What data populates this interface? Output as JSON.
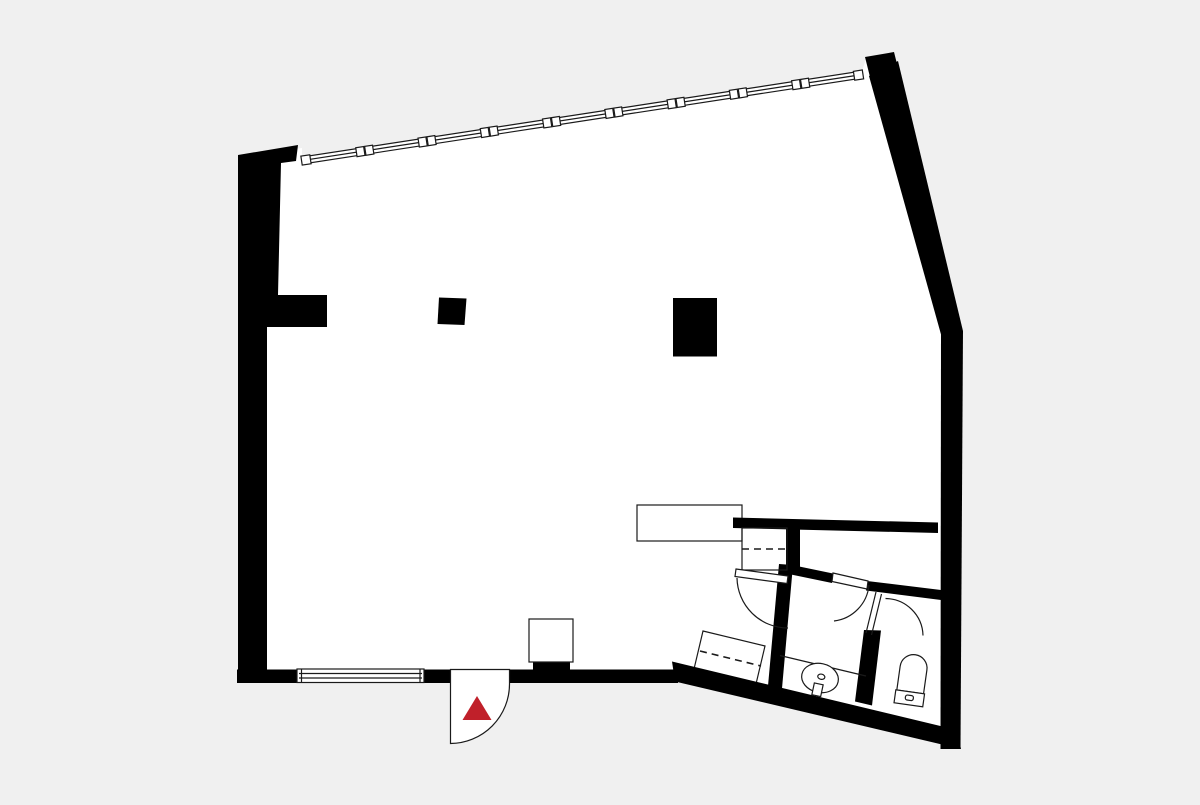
{
  "meta": {
    "kind": "architectural-floor-plan",
    "canvas": {
      "width": 1200,
      "height": 800
    },
    "description": "Black-wall floor plan of one large open room with an angled ribbon window at top, angled right wall, bathroom block at lower right, entrance door with red triangle marker at bottom"
  },
  "colors": {
    "background": "#f0f0f0",
    "floor": "#ffffff",
    "wall": "#000000",
    "line": "#1a1a1a",
    "accent": "#c0202a"
  },
  "entrance": {
    "marker_icon": "red-triangle-up",
    "door_swing": "quarter-circle-outward"
  },
  "windows": {
    "top_ribbon": {
      "mullion_pairs": 8,
      "end_caps": 2,
      "style": "double-line"
    },
    "bottom": {
      "style": "double-line",
      "end_caps": 2
    }
  },
  "structure": {
    "columns": [
      "small-square-column",
      "large-rect-column"
    ],
    "wall_stubs": [
      "left-wall-stub",
      "hall-stub"
    ]
  },
  "fixtures": [
    "counter-sideboard",
    "wardrobe-top-dashed",
    "wardrobe-bottom-dashed",
    "door-swing-hall",
    "door-swing-bathroom",
    "door-swing-wc",
    "vanity-counter",
    "washbasin-oval",
    "toilet-with-cistern",
    "entry-pedestal"
  ]
}
